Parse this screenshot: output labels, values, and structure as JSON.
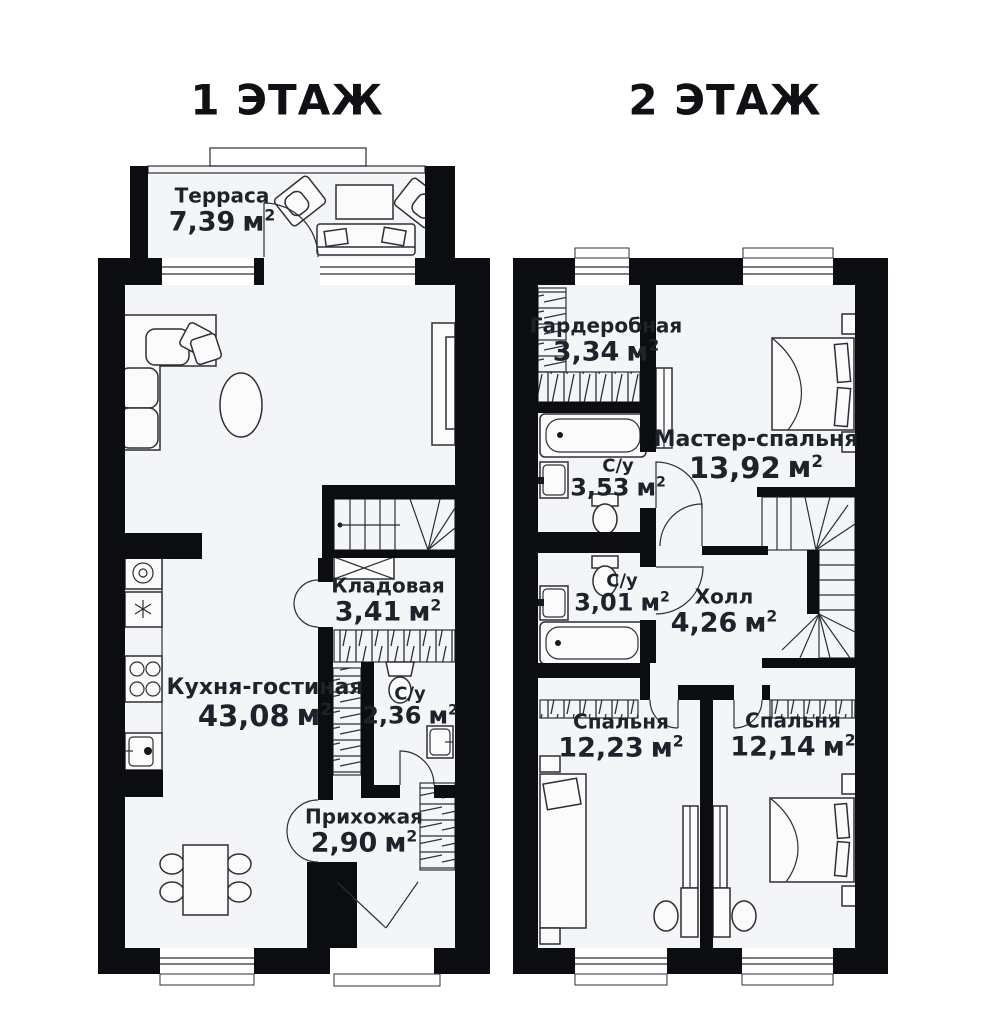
{
  "units": {
    "base": "м",
    "sup": "2"
  },
  "colors": {
    "wall": "#0c0d10",
    "room_fill": "#f4f5f6",
    "line": "#2c2f36",
    "text": "#1e222a"
  },
  "floors": [
    {
      "id": "floor1",
      "title": "1 ЭТАЖ",
      "rooms": [
        {
          "key": "terrace",
          "name": "Терраса",
          "area": "7,39"
        },
        {
          "key": "kitchen_living",
          "name": "Кухня-гостиная",
          "area": "43,08"
        },
        {
          "key": "storage",
          "name": "Кладовая",
          "area": "3,41"
        },
        {
          "key": "bathroom1",
          "name": "С/у",
          "area": "2,36"
        },
        {
          "key": "hallway",
          "name": "Прихожая",
          "area": "2,90"
        }
      ]
    },
    {
      "id": "floor2",
      "title": "2 ЭТАЖ",
      "rooms": [
        {
          "key": "wardrobe",
          "name": "Гардеробная",
          "area": "3,34"
        },
        {
          "key": "master_bedroom",
          "name": "Мастер-спальня",
          "area": "13,92"
        },
        {
          "key": "bathroom2",
          "name": "С/у",
          "area": "3,53"
        },
        {
          "key": "bathroom3",
          "name": "С/у",
          "area": "3,01"
        },
        {
          "key": "hall",
          "name": "Холл",
          "area": "4,26"
        },
        {
          "key": "bedroom1",
          "name": "Спальня",
          "area": "12,23"
        },
        {
          "key": "bedroom2",
          "name": "Спальня",
          "area": "12,14"
        }
      ]
    }
  ]
}
